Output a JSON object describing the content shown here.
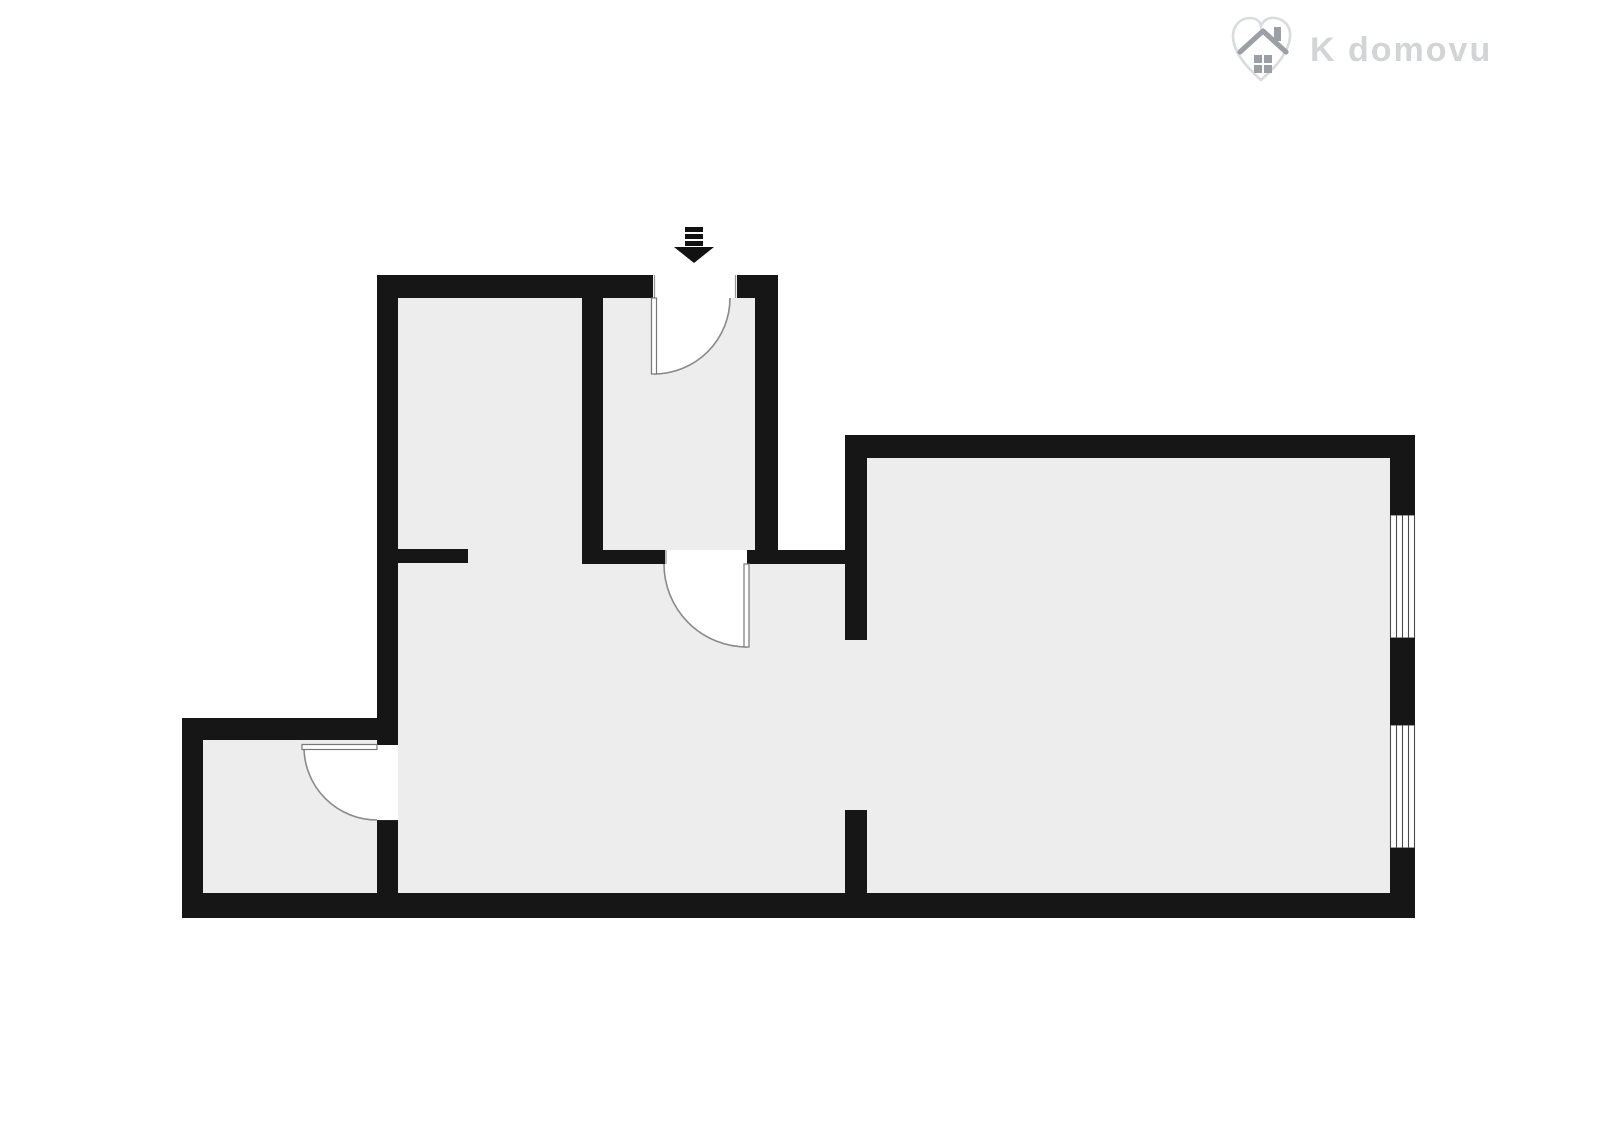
{
  "page": {
    "width": 1600,
    "height": 1131,
    "background": "#ffffff"
  },
  "logo": {
    "text": "K domovu",
    "icon": "heart-house-icon"
  },
  "colors": {
    "background": "#ffffff",
    "wall": "#161616",
    "floor": "#ededee",
    "door_line": "#8a8a8a",
    "leaf_line": "#777777",
    "jamb_line": "#9a9a9a",
    "window_line": "#4a4a4a",
    "window_cap": "#9a9a9a",
    "arrow": "#111111",
    "logo_text": "#d3d4d5",
    "logo_heart": "#dadbdc",
    "logo_house": "#9aa0a5"
  },
  "floorplan": {
    "type": "apartment-floor-plan",
    "style": "black-walls-white-background-gray-floor",
    "rooms_visible": 5,
    "doors": [
      {
        "id": "entrance-door",
        "location": "top-wall",
        "swing": "quarter-arc-inward"
      },
      {
        "id": "hall-door",
        "location": "hall-to-living-area",
        "swing": "quarter-arc-down"
      },
      {
        "id": "small-room-door",
        "location": "living-area-to-small-room",
        "swing": "quarter-arc-left"
      }
    ],
    "windows": [
      {
        "id": "window-1",
        "location": "right-wall-upper"
      },
      {
        "id": "window-2",
        "location": "right-wall-lower"
      }
    ],
    "entrance_marker": "down-arrow-with-bars"
  }
}
